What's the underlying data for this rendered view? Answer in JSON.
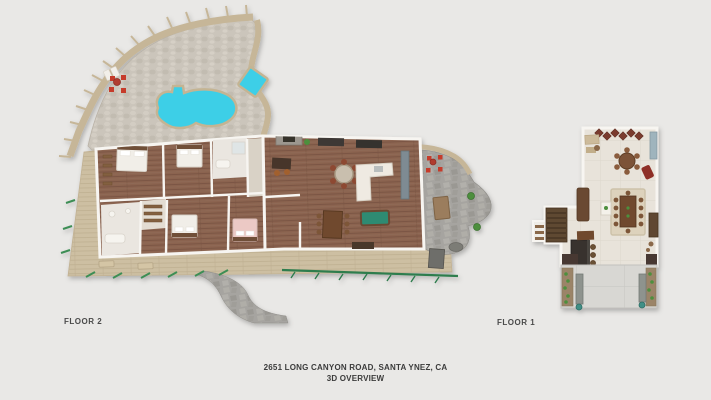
{
  "labels": {
    "floor2": "FLOOR 2",
    "floor1": "FLOOR 1"
  },
  "footer": {
    "address": "2651 LONG CANYON ROAD, SANTA YNEZ,  CA",
    "subtitle": "3D OVERVIEW"
  },
  "palette": {
    "bg": "#e9e8e6",
    "label-text": "#4a4a4a",
    "footer-text": "#3b3b3b",
    "deck-tan": "#cdbfa2",
    "fence-tan": "#c6b698",
    "pool": "#3ccfe7",
    "pool-rim": "#c4b493",
    "stone-light": "#cbc5bb",
    "stone-dark": "#a6a4a0",
    "wood-floor": "#8b6450",
    "wall-white": "#f7f5f1",
    "bed-white": "#f1eee8",
    "bed-pink": "#ecc9c5",
    "accent-red": "#c63a2a",
    "hedge-green": "#2f7d4e",
    "plant-green": "#4e8f3e",
    "pool-table-green": "#2f8b72",
    "furn-brown": "#6f4a2e",
    "furn-dark": "#3c3835",
    "cream-floor": "#e8e3da",
    "rug": "#ddd2bc",
    "concrete": "#d8d7d3",
    "soil": "#9b8468",
    "bench-gray": "#8e938e",
    "teal-pot": "#3f8f86",
    "counter-blue": "#9fb4bd",
    "wine-rack": "#7a3b2e"
  }
}
